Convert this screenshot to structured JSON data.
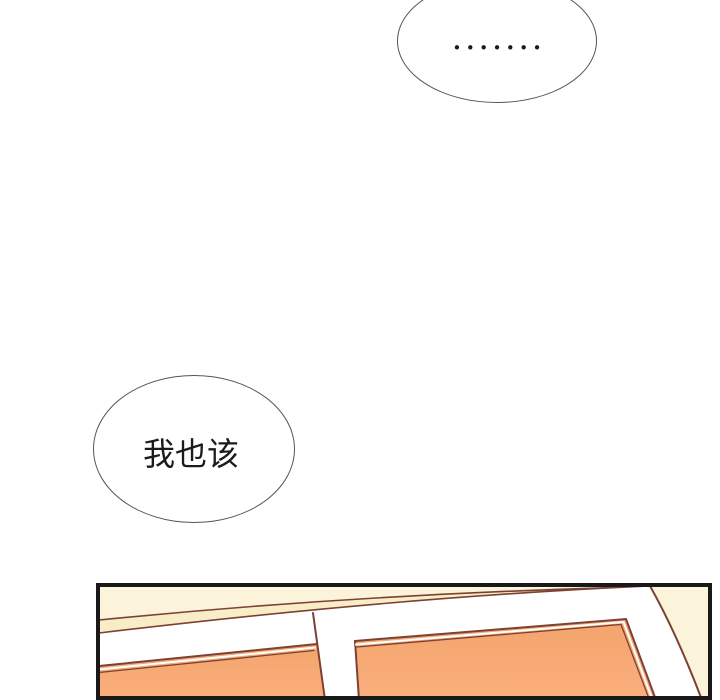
{
  "bubbles": {
    "ellipsis": {
      "text": "•••••••"
    },
    "thought": {
      "text": "我也该"
    }
  },
  "colors": {
    "wall": "#FBF3DA",
    "strip": "#F8EDC6",
    "frame": "#FFFFFF",
    "outline": "#7C4134",
    "pane_top": "#F3A46C",
    "pane_bottom": "#FBAF7D",
    "border": "#191919",
    "bubble_stroke": "#555555",
    "ink": "#1B1B1B"
  }
}
